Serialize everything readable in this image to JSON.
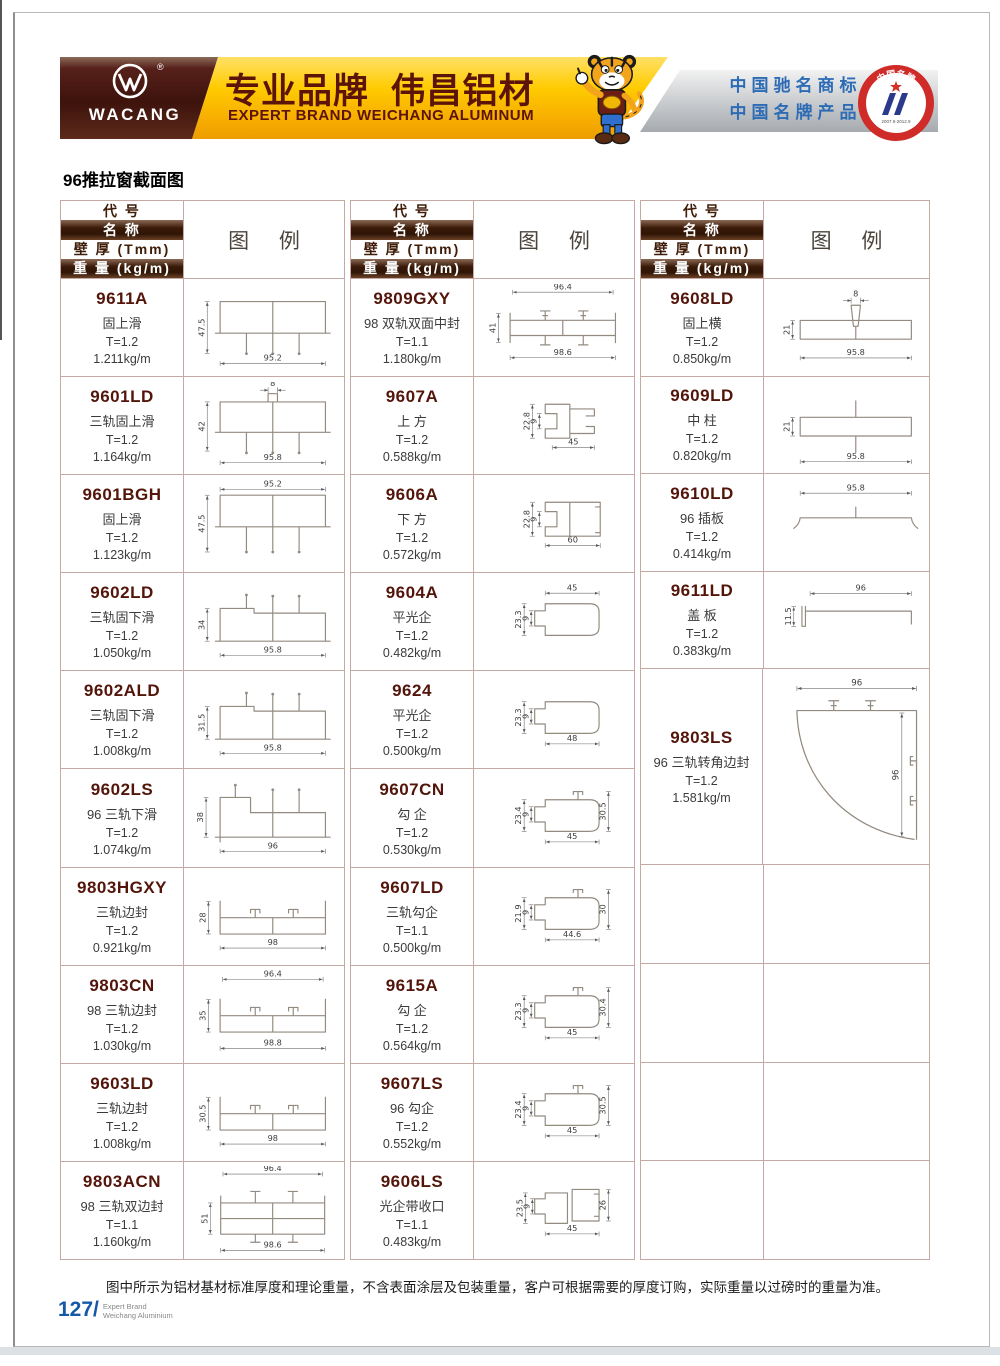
{
  "banner": {
    "logo_text": "WACANG",
    "logo_reg": "®",
    "title": "专业品牌  伟昌铝材",
    "subtitle": "EXPERT BRAND WEICHANG ALUMINUM",
    "claim1": "中国驰名商标",
    "claim2": "中国名牌产品",
    "badge": {
      "top": "中国名牌",
      "bottom": "CHINA TOP BRAND",
      "dates": "2007.9-2012.9"
    }
  },
  "section_title": "96推拉窗截面图",
  "table_header": {
    "code": "代 号",
    "name": "名 称",
    "thickness": "壁 厚 (Tmm)",
    "weight": "重 量 (kg/m)",
    "legend": "图 例"
  },
  "columns": [
    [
      {
        "code": "9611A",
        "name": "固上滑",
        "thickness": "T=1.2",
        "weight": "1.211kg/m",
        "shape": "topSlide",
        "dims": {
          "left": "47.5",
          "bottom": "95.2"
        }
      },
      {
        "code": "9601LD",
        "name": "三轨固上滑",
        "thickness": "T=1.2",
        "weight": "1.164kg/m",
        "shape": "topSlideTab",
        "dims": {
          "top": "8",
          "left": "42",
          "bottom": "95.8"
        }
      },
      {
        "code": "9601BGH",
        "name": "固上滑",
        "thickness": "T=1.2",
        "weight": "1.123kg/m",
        "shape": "topSlideTop",
        "dims": {
          "top": "95.2",
          "left": "47.5"
        }
      },
      {
        "code": "9602LD",
        "name": "三轨固下滑",
        "thickness": "T=1.2",
        "weight": "1.050kg/m",
        "shape": "bottomSlide",
        "dims": {
          "left": "34",
          "bottom": "95.8"
        }
      },
      {
        "code": "9602ALD",
        "name": "三轨固下滑",
        "thickness": "T=1.2",
        "weight": "1.008kg/m",
        "shape": "bottomSlide",
        "dims": {
          "left": "31.5",
          "bottom": "95.8"
        }
      },
      {
        "code": "9602LS",
        "name": "96 三轨下滑",
        "thickness": "T=1.2",
        "weight": "1.074kg/m",
        "shape": "bottomSlideLS",
        "dims": {
          "left": "38",
          "bottom": "96"
        }
      },
      {
        "code": "9803HGXY",
        "name": "三轨边封",
        "thickness": "T=1.2",
        "weight": "0.921kg/m",
        "shape": "edgeSeal",
        "dims": {
          "left": "28",
          "bottom": "98"
        }
      },
      {
        "code": "9803CN",
        "name": "98 三轨边封",
        "thickness": "T=1.2",
        "weight": "1.030kg/m",
        "shape": "edgeSealTop",
        "dims": {
          "top": "96.4",
          "left": "35",
          "bottom": "98.8"
        }
      },
      {
        "code": "9603LD",
        "name": "三轨边封",
        "thickness": "T=1.2",
        "weight": "1.008kg/m",
        "shape": "edgeSeal",
        "dims": {
          "left": "30.5",
          "bottom": "98"
        }
      },
      {
        "code": "9803ACN",
        "name": "98 三轨双边封",
        "thickness": "T=1.1",
        "weight": "1.160kg/m",
        "shape": "doubleEdgeSeal",
        "dims": {
          "top": "96.4",
          "left": "51",
          "bottom": "98.6"
        }
      }
    ],
    [
      {
        "code": "9809GXY",
        "name": "98 双轨双面中封",
        "thickness": "T=1.1",
        "weight": "1.180kg/m",
        "shape": "midSeal",
        "dims": {
          "top": "96.4",
          "left": "41",
          "bottom": "98.6"
        }
      },
      {
        "code": "9607A",
        "name": "上 方",
        "thickness": "T=1.2",
        "weight": "0.588kg/m",
        "shape": "channelTop",
        "dims": {
          "left": "22.8",
          "inner": "9",
          "bottom": "45"
        }
      },
      {
        "code": "9606A",
        "name": "下 方",
        "thickness": "T=1.2",
        "weight": "0.572kg/m",
        "shape": "channelBottom",
        "dims": {
          "left": "22.8",
          "inner": "9",
          "bottom": "60"
        }
      },
      {
        "code": "9604A",
        "name": "平光企",
        "thickness": "T=1.2",
        "weight": "0.482kg/m",
        "shape": "flatHookTop",
        "dims": {
          "left": "23.3",
          "inner": "9",
          "top": "45"
        }
      },
      {
        "code": "9624",
        "name": "平光企",
        "thickness": "T=1.2",
        "weight": "0.500kg/m",
        "shape": "flatHookBottom",
        "dims": {
          "left": "23.3",
          "inner": "9",
          "bottom": "48"
        }
      },
      {
        "code": "9607CN",
        "name": "勾 企",
        "thickness": "T=1.2",
        "weight": "0.530kg/m",
        "shape": "hook",
        "dims": {
          "left": "23.4",
          "inner": "9",
          "right": "30.5",
          "bottom": "45"
        }
      },
      {
        "code": "9607LD",
        "name": "三轨勾企",
        "thickness": "T=1.1",
        "weight": "0.500kg/m",
        "shape": "hook",
        "dims": {
          "left": "21.9",
          "inner": "9",
          "right": "30",
          "bottom": "44.6"
        }
      },
      {
        "code": "9615A",
        "name": "勾 企",
        "thickness": "T=1.2",
        "weight": "0.564kg/m",
        "shape": "hook",
        "dims": {
          "left": "23.3",
          "inner": "9",
          "right": "30.4",
          "bottom": "45"
        }
      },
      {
        "code": "9607LS",
        "name": "96 勾企",
        "thickness": "T=1.2",
        "weight": "0.552kg/m",
        "shape": "hook",
        "dims": {
          "left": "23.4",
          "inner": "9",
          "right": "30.5",
          "bottom": "45"
        }
      },
      {
        "code": "9606LS",
        "name": "光企带收口",
        "thickness": "T=1.1",
        "weight": "0.483kg/m",
        "shape": "lightHook",
        "dims": {
          "left": "23.5",
          "inner": "9",
          "right": "26",
          "bottom": "45"
        }
      }
    ],
    [
      {
        "code": "9608LD",
        "name": "固上横",
        "thickness": "T=1.2",
        "weight": "0.850kg/m",
        "shape": "topBar",
        "dims": {
          "top": "8",
          "left": "21",
          "bottom": "95.8"
        }
      },
      {
        "code": "9609LD",
        "name": "中 柱",
        "thickness": "T=1.2",
        "weight": "0.820kg/m",
        "shape": "midColumn",
        "dims": {
          "left": "21",
          "bottom": "95.8"
        }
      },
      {
        "code": "9610LD",
        "name": "96 插板",
        "thickness": "T=1.2",
        "weight": "0.414kg/m",
        "shape": "insertPlate",
        "dims": {
          "top": "95.8"
        }
      },
      {
        "code": "9611LD",
        "name": "盖 板",
        "thickness": "T=1.2",
        "weight": "0.383kg/m",
        "shape": "coverPlate",
        "dims": {
          "left": "11.5",
          "top": "96"
        }
      },
      {
        "code": "9803LS",
        "name": "96 三轨转角边封",
        "thickness": "T=1.2",
        "weight": "1.581kg/m",
        "shape": "cornerSeal",
        "dims": {
          "top": "96",
          "right": "96"
        }
      },
      {
        "empty": true
      },
      {
        "empty": true
      },
      {
        "empty": true
      },
      {
        "empty": true
      }
    ]
  ],
  "footer_note": "图中所示为铝材基材标准厚度和理论重量，不含表面涂层及包装重量，客户可根据需要的厚度订购，实际重量以过磅时的重量为准。",
  "page": {
    "number": "127/",
    "line1": "Expert Brand",
    "line2": "Weichang Aluminium"
  }
}
